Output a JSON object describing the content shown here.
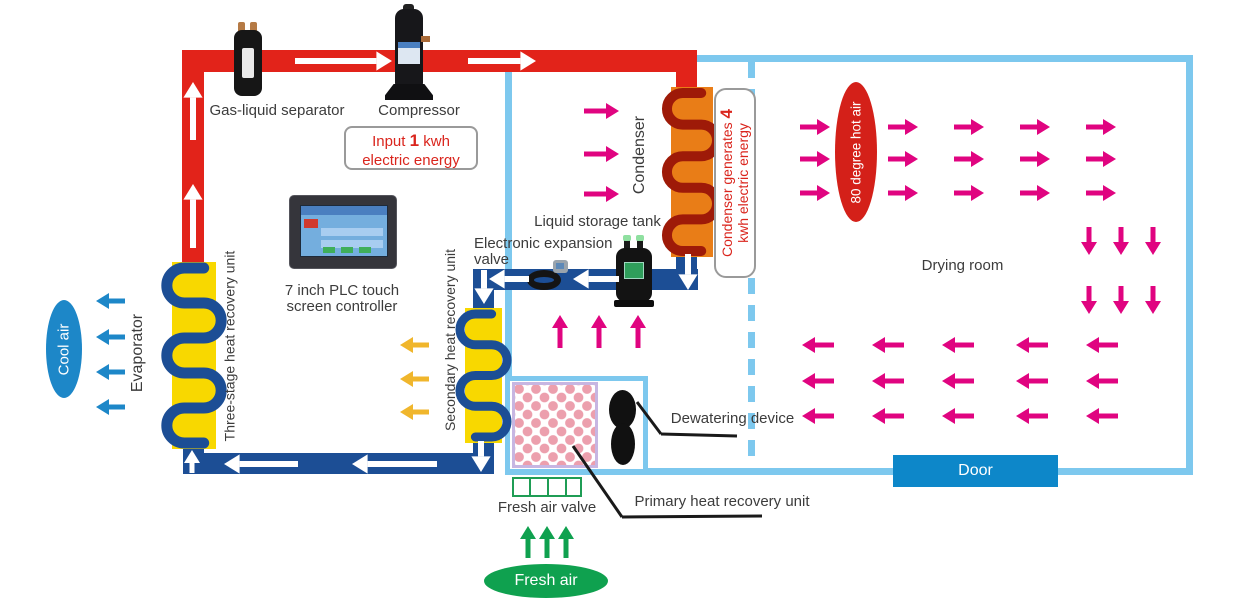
{
  "colors": {
    "red": "#e2231a",
    "pipeBlue": "#1c4e95",
    "wall": "#7dc8ee",
    "pink": "#e00480",
    "white": "#ffffff",
    "yellow": "#f8d800",
    "orange": "#e97d17",
    "coilRed": "#9e1a08",
    "green": "#0fa14f",
    "coolBlue": "#1d87c8",
    "amber": "#f0b62c",
    "black": "#1a1a1a"
  },
  "labels": {
    "gas_liquid_separator": "Gas-liquid separator",
    "compressor": "Compressor",
    "plc_line1": "7 inch PLC touch",
    "plc_line2": "screen controller",
    "liquid_storage_tank": "Liquid storage tank",
    "eev_line1": "Electronic expansion",
    "eev_line2": "valve",
    "condenser": "Condenser",
    "evaporator": "Evaporator",
    "three_stage": "Three-stage heat recovery unit",
    "secondary": "Secondary heat recovery unit",
    "primary": "Primary heat recovery unit",
    "dewatering": "Dewatering device",
    "fresh_air_valve": "Fresh air valve",
    "drying_room": "Drying room",
    "door": "Door",
    "cool_air": "Cool air",
    "fresh_air": "Fresh air",
    "hot_air": "80 degree hot air"
  },
  "energy_input": {
    "prefix": "Input",
    "value": "1",
    "suffix": "kwh",
    "line2": "electric energy"
  },
  "energy_condenser": {
    "line1": "Condenser generates",
    "value": "4",
    "line2": "kwh electric energy"
  },
  "pipes": [
    {
      "x": 182,
      "y": 50,
      "w": 515,
      "h": 22,
      "c": "red",
      "n": "hot-pipe-top"
    },
    {
      "x": 182,
      "y": 50,
      "w": 22,
      "h": 213,
      "c": "red",
      "n": "hot-pipe-left"
    },
    {
      "x": 676,
      "y": 62,
      "w": 21,
      "h": 30,
      "c": "red",
      "n": "hot-pipe-condenser-drop"
    },
    {
      "x": 676,
      "y": 250,
      "w": 21,
      "h": 40,
      "c": "pipeBlue",
      "n": "cold-pipe-condenser-exit"
    },
    {
      "x": 478,
      "y": 269,
      "w": 220,
      "h": 21,
      "c": "pipeBlue",
      "n": "cold-pipe-middle"
    },
    {
      "x": 473,
      "y": 269,
      "w": 21,
      "h": 190,
      "c": "pipeBlue",
      "n": "cold-pipe-secondary-drop"
    },
    {
      "x": 183,
      "y": 453,
      "w": 311,
      "h": 21,
      "c": "pipeBlue",
      "n": "cold-pipe-bottom"
    },
    {
      "x": 183,
      "y": 441,
      "w": 21,
      "h": 33,
      "c": "pipeBlue",
      "n": "cold-pipe-evaporator-riser"
    }
  ],
  "units": [
    {
      "x": 172,
      "y": 262,
      "w": 44,
      "h": 187,
      "bg": "yellow",
      "coil": "pipeBlue",
      "turns": 5,
      "sw": 11,
      "n": "three-stage-heat-recovery-coil"
    },
    {
      "x": 465,
      "y": 308,
      "w": 37,
      "h": 135,
      "bg": "yellow",
      "coil": "pipeBlue",
      "turns": 4,
      "sw": 9,
      "n": "secondary-heat-recovery-coil"
    },
    {
      "x": 671,
      "y": 87,
      "w": 42,
      "h": 170,
      "bg": "orange",
      "coil": "coilRed",
      "turns": 5,
      "sw": 10,
      "n": "condenser-coil"
    }
  ],
  "arrows": [
    [
      295,
      61,
      392,
      61,
      "white",
      6
    ],
    [
      468,
      61,
      536,
      61,
      "white",
      6
    ],
    [
      193,
      140,
      193,
      82,
      "white",
      6
    ],
    [
      193,
      248,
      193,
      184,
      "white",
      6
    ],
    [
      688,
      254,
      688,
      290,
      "white",
      6
    ],
    [
      619,
      279,
      573,
      279,
      "white",
      6
    ],
    [
      529,
      279,
      489,
      279,
      "white",
      6
    ],
    [
      484,
      270,
      484,
      304,
      "white",
      6
    ],
    [
      481,
      441,
      481,
      472,
      "white",
      6
    ],
    [
      437,
      464,
      352,
      464,
      "white",
      6
    ],
    [
      298,
      464,
      224,
      464,
      "white",
      6
    ],
    [
      192,
      473,
      192,
      450,
      "white",
      5
    ],
    [
      125,
      301,
      96,
      301,
      "coolBlue",
      5
    ],
    [
      125,
      337,
      96,
      337,
      "coolBlue",
      5
    ],
    [
      125,
      372,
      96,
      372,
      "coolBlue",
      5
    ],
    [
      125,
      407,
      96,
      407,
      "coolBlue",
      5
    ],
    [
      429,
      345,
      400,
      345,
      "amber",
      5
    ],
    [
      429,
      379,
      400,
      379,
      "amber",
      5
    ],
    [
      429,
      412,
      400,
      412,
      "amber",
      5
    ],
    [
      584,
      111,
      619,
      111,
      "pink",
      5
    ],
    [
      584,
      154,
      619,
      154,
      "pink",
      5
    ],
    [
      584,
      194,
      619,
      194,
      "pink",
      5
    ],
    [
      560,
      348,
      560,
      315,
      "pink",
      5
    ],
    [
      599,
      348,
      599,
      315,
      "pink",
      5
    ],
    [
      638,
      348,
      638,
      315,
      "pink",
      5
    ],
    [
      528,
      558,
      528,
      526,
      "green",
      5
    ],
    [
      547,
      558,
      547,
      526,
      "green",
      5
    ],
    [
      566,
      558,
      566,
      526,
      "green",
      5
    ],
    [
      800,
      127,
      830,
      127,
      "pink",
      5
    ],
    [
      888,
      127,
      918,
      127,
      "pink",
      5
    ],
    [
      954,
      127,
      984,
      127,
      "pink",
      5
    ],
    [
      1020,
      127,
      1050,
      127,
      "pink",
      5
    ],
    [
      1086,
      127,
      1116,
      127,
      "pink",
      5
    ],
    [
      800,
      159,
      830,
      159,
      "pink",
      5
    ],
    [
      888,
      159,
      918,
      159,
      "pink",
      5
    ],
    [
      954,
      159,
      984,
      159,
      "pink",
      5
    ],
    [
      1020,
      159,
      1050,
      159,
      "pink",
      5
    ],
    [
      1086,
      159,
      1116,
      159,
      "pink",
      5
    ],
    [
      800,
      193,
      830,
      193,
      "pink",
      5
    ],
    [
      888,
      193,
      918,
      193,
      "pink",
      5
    ],
    [
      954,
      193,
      984,
      193,
      "pink",
      5
    ],
    [
      1020,
      193,
      1050,
      193,
      "pink",
      5
    ],
    [
      1086,
      193,
      1116,
      193,
      "pink",
      5
    ],
    [
      1089,
      227,
      1089,
      255,
      "pink",
      5
    ],
    [
      1121,
      227,
      1121,
      255,
      "pink",
      5
    ],
    [
      1153,
      227,
      1153,
      255,
      "pink",
      5
    ],
    [
      1089,
      286,
      1089,
      314,
      "pink",
      5
    ],
    [
      1121,
      286,
      1121,
      314,
      "pink",
      5
    ],
    [
      1153,
      286,
      1153,
      314,
      "pink",
      5
    ],
    [
      834,
      345,
      802,
      345,
      "pink",
      5
    ],
    [
      904,
      345,
      872,
      345,
      "pink",
      5
    ],
    [
      974,
      345,
      942,
      345,
      "pink",
      5
    ],
    [
      1048,
      345,
      1016,
      345,
      "pink",
      5
    ],
    [
      1118,
      345,
      1086,
      345,
      "pink",
      5
    ],
    [
      834,
      381,
      802,
      381,
      "pink",
      5
    ],
    [
      904,
      381,
      872,
      381,
      "pink",
      5
    ],
    [
      974,
      381,
      942,
      381,
      "pink",
      5
    ],
    [
      1048,
      381,
      1016,
      381,
      "pink",
      5
    ],
    [
      1118,
      381,
      1086,
      381,
      "pink",
      5
    ],
    [
      834,
      416,
      802,
      416,
      "pink",
      5
    ],
    [
      904,
      416,
      872,
      416,
      "pink",
      5
    ],
    [
      974,
      416,
      942,
      416,
      "pink",
      5
    ],
    [
      1048,
      416,
      1016,
      416,
      "pink",
      5
    ],
    [
      1118,
      416,
      1086,
      416,
      "pink",
      5
    ]
  ],
  "callouts": [
    [
      637,
      402,
      661,
      434
    ],
    [
      661,
      434,
      737,
      436
    ],
    [
      573,
      446,
      622,
      517
    ],
    [
      622,
      517,
      762,
      516
    ]
  ]
}
